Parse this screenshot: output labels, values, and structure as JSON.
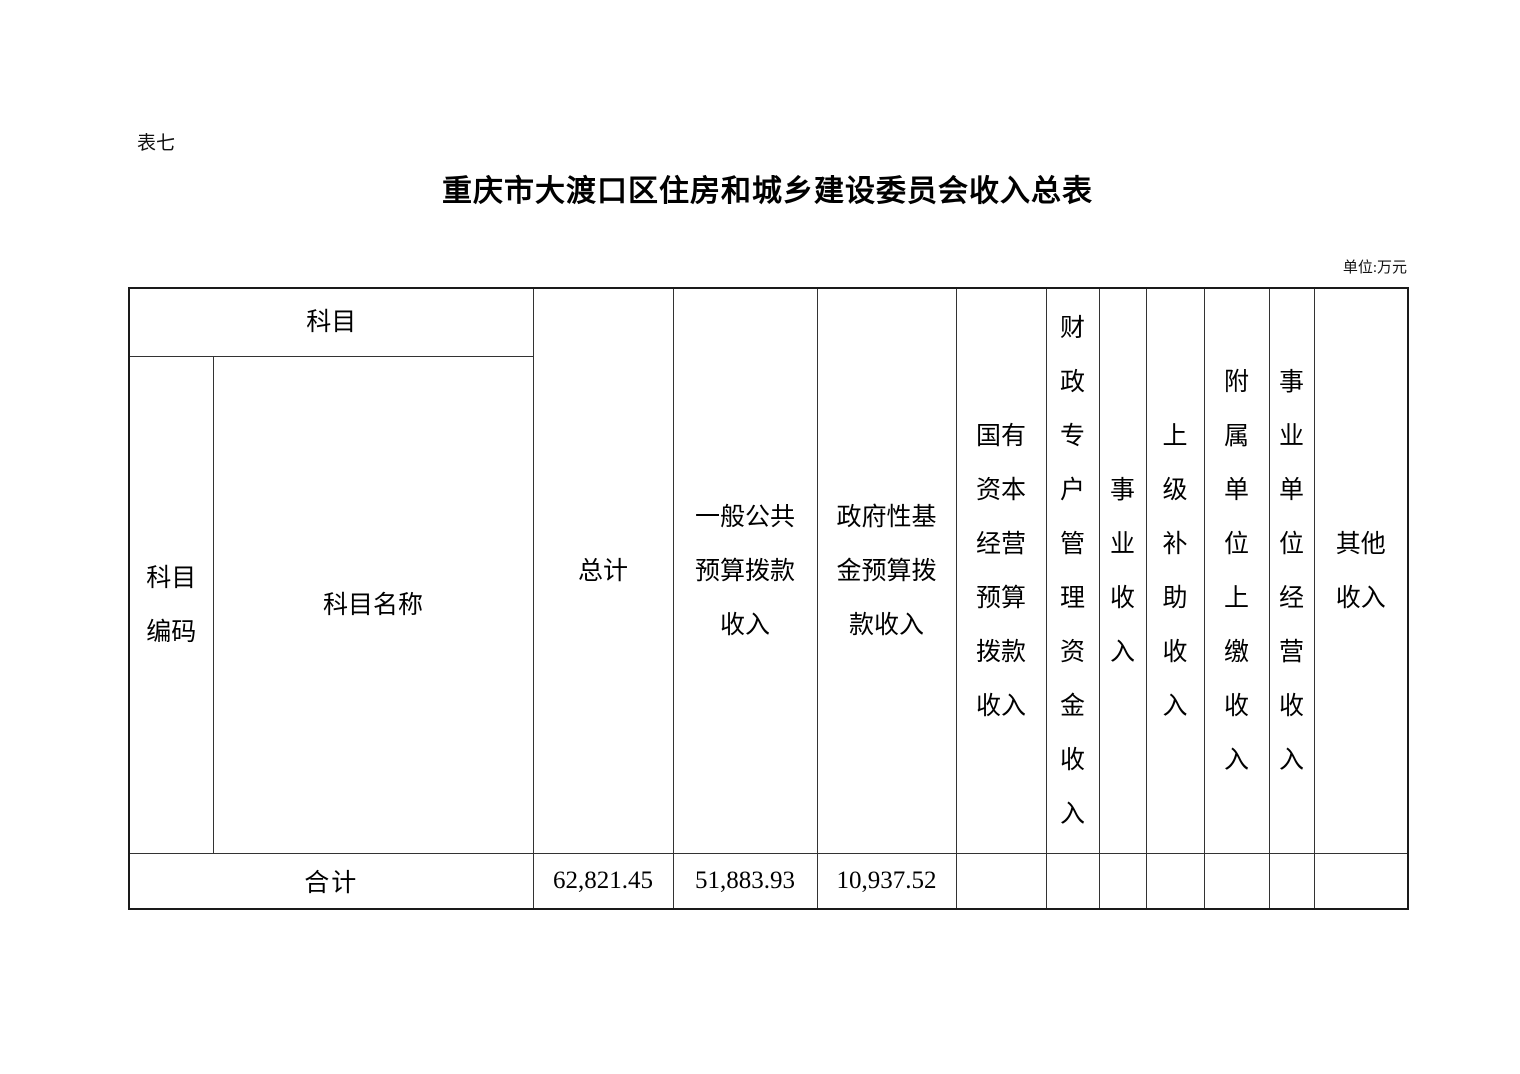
{
  "page": {
    "table_label": "表七",
    "title": "重庆市大渡口区住房和城乡建设委员会收入总表",
    "unit_note": "单位:万元"
  },
  "table": {
    "header": {
      "subject": "科目",
      "subject_code": "科目\n编码",
      "subject_name": "科目名称",
      "total": "总计",
      "general_public_budget": "一般公共\n预算拨款\n收入",
      "government_fund_budget": "政府性基\n金预算拨\n款收入",
      "state_capital_budget": "国有\n资本\n经营\n预算\n拨款\n收入",
      "fiscal_special_account": "财\n政\n专\n户\n管\n理\n资\n金\n收\n入",
      "business_income": "事\n业\n收\n入",
      "superior_subsidy": "上\n级\n补\n助\n收\n入",
      "affiliated_unit_remit": "附\n属\n单\n位\n上\n缴\n收\n入",
      "institution_operating": "事\n业\n单\n位\n经\n营\n收\n入",
      "other_income": "其他\n收入"
    },
    "total_row": {
      "label": "合计",
      "total": "62,821.45",
      "general_public_budget": "51,883.93",
      "government_fund_budget": "10,937.52",
      "state_capital_budget": "",
      "fiscal_special_account": "",
      "business_income": "",
      "superior_subsidy": "",
      "affiliated_unit_remit": "",
      "institution_operating": "",
      "other_income": ""
    }
  }
}
